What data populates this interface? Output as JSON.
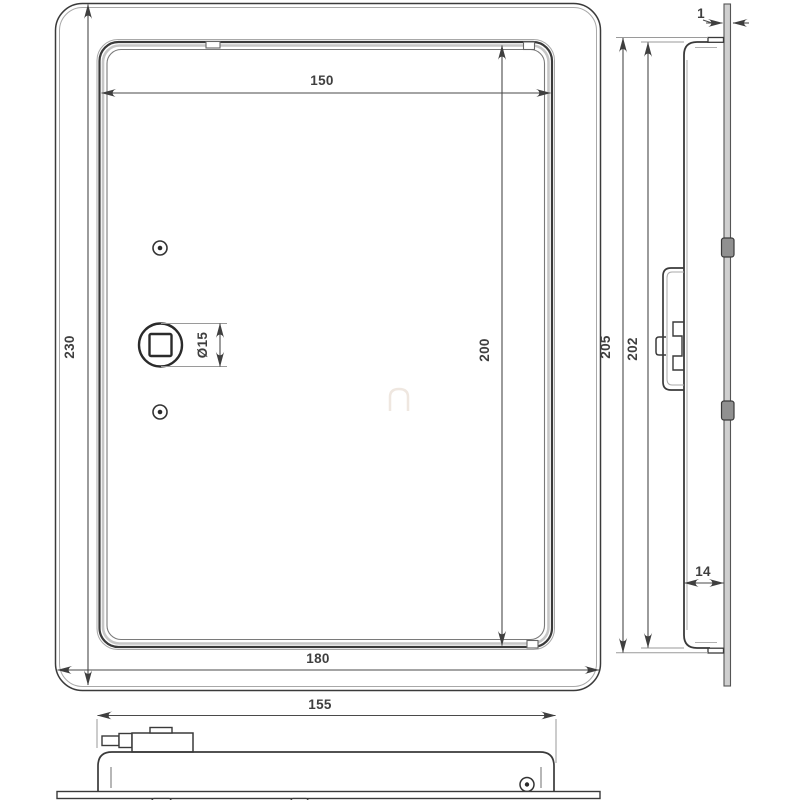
{
  "drawing": {
    "title": "Access panel technical drawing (three views)",
    "views": {
      "front": {
        "name": "front-view",
        "dims": {
          "frame_height": "230",
          "door_width": "150",
          "door_height": "200",
          "frame_width": "180",
          "lock_diameter": "Ø15"
        }
      },
      "side": {
        "name": "side-view",
        "dims": {
          "flange_thickness": "1",
          "outer_height": "205",
          "panel_height": "202",
          "panel_depth": "14"
        }
      },
      "bottom": {
        "name": "bottom-view",
        "dims": {
          "panel_width": "155"
        }
      }
    },
    "colors": {
      "background": "#ffffff",
      "line_dark": "#3a3a3a",
      "line_light": "#a8a8a8",
      "fill_gray": "#c9c9c9",
      "dim_text": "#3f3f3f"
    }
  }
}
